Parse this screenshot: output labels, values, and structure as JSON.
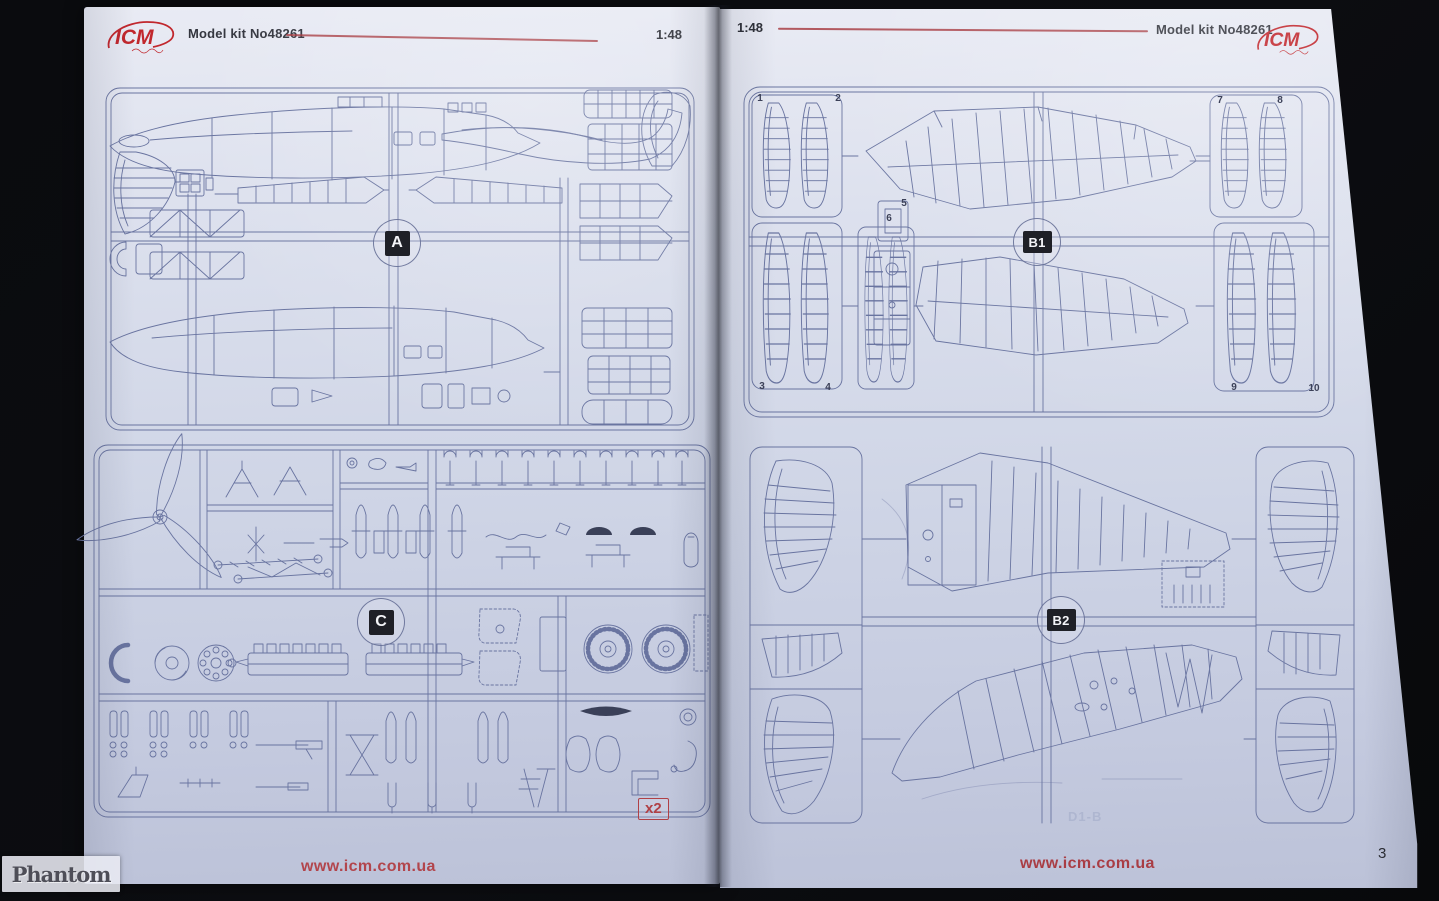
{
  "document": {
    "brand": "ICM",
    "kit_title": "Model kit No48261",
    "scale": "1:48"
  },
  "colors": {
    "logo_red": "#c1272d",
    "accent_red": "#a5343b",
    "drawing_blue": "#6974a0",
    "paper": "#cfd5e6"
  },
  "left_page": {
    "header": {
      "title": "Model kit No48261",
      "scale": "1:48"
    },
    "sprue_a": {
      "label": "A"
    },
    "sprue_c": {
      "label": "C",
      "quantity": "x2"
    },
    "footer_url": "www.icm.com.ua"
  },
  "right_page": {
    "header": {
      "scale": "1:48",
      "title": "Model kit No48261"
    },
    "sprue_b1": {
      "label": "B1",
      "frame_numbers": [
        "1",
        "2",
        "3",
        "4",
        "5",
        "6",
        "7",
        "8",
        "9",
        "10"
      ]
    },
    "sprue_b2": {
      "label": "B2"
    },
    "showthrough": "D1-B",
    "footer_url": "www.icm.com.ua",
    "page_number": "3"
  },
  "watermark": "Phantom"
}
